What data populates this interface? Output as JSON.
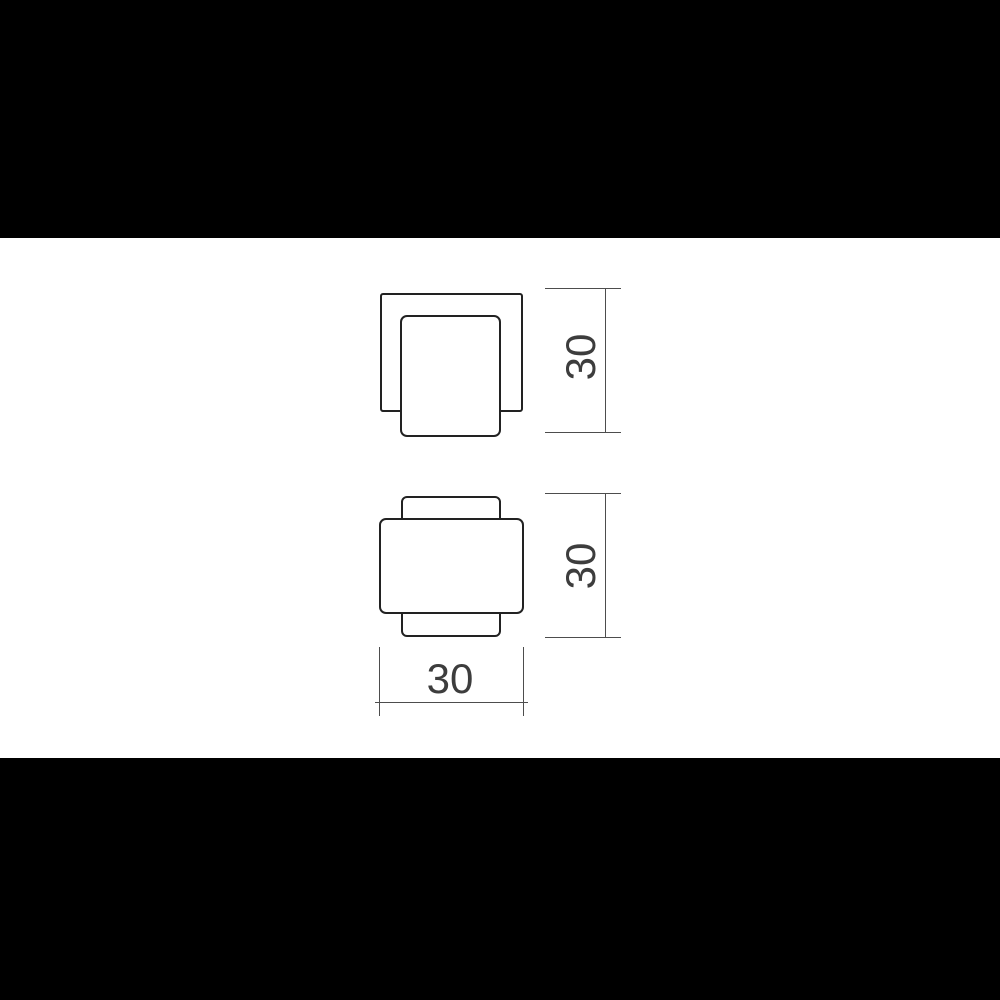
{
  "scene": {
    "background_color": "#000000",
    "canvas_color": "#ffffff",
    "kind": "technical-dimension-drawing"
  },
  "drawing": {
    "line_colors": {
      "part_outline": "#222222",
      "dimension_line": "#4d4d4d",
      "dimension_text": "#3d3d3d"
    },
    "views": {
      "side_view": {
        "name": "side-view",
        "height_dim": {
          "value": "30",
          "orientation": "vertical"
        }
      },
      "front_view": {
        "name": "front-view",
        "height_dim": {
          "value": "30",
          "orientation": "vertical"
        },
        "width_dim": {
          "value": "30",
          "orientation": "horizontal"
        }
      }
    }
  }
}
